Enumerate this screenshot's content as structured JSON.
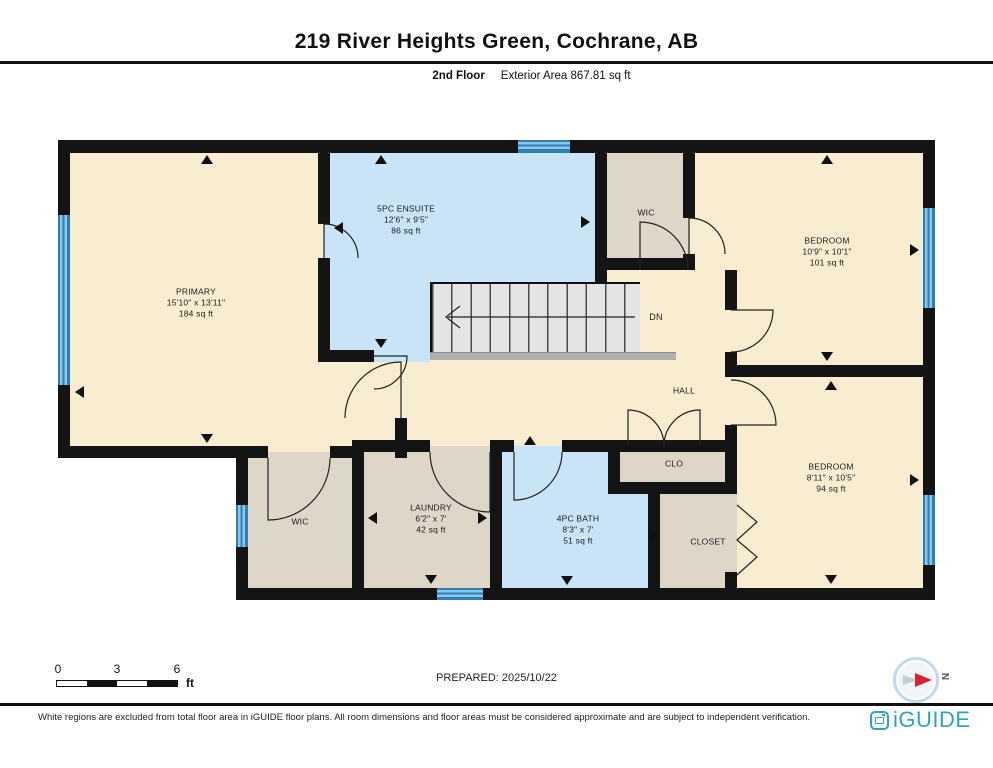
{
  "header": {
    "title": "219 River Heights Green, Cochrane, AB",
    "floor": "2nd Floor",
    "area": "Exterior Area 867.81 sq ft"
  },
  "rooms": {
    "primary": {
      "name": "PRIMARY",
      "dims": "15'10\" x 13'11\"",
      "area": "184 sq ft"
    },
    "ensuite": {
      "name": "5PC ENSUITE",
      "dims": "12'6\" x 9'5\"",
      "area": "86 sq ft"
    },
    "wic_top": {
      "name": "WIC"
    },
    "bedroom_ne": {
      "name": "BEDROOM",
      "dims": "10'9\" x 10'1\"",
      "area": "101 sq ft"
    },
    "bedroom_se": {
      "name": "BEDROOM",
      "dims": "8'11\" x 10'5\"",
      "area": "94 sq ft"
    },
    "hall": {
      "name": "HALL"
    },
    "stairs": {
      "label": "DN"
    },
    "clo": {
      "name": "CLO"
    },
    "closet": {
      "name": "CLOSET"
    },
    "wic_bottom": {
      "name": "WIC"
    },
    "laundry": {
      "name": "LAUNDRY",
      "dims": "6'2\" x 7'",
      "area": "42 sq ft"
    },
    "bath": {
      "name": "4PC BATH",
      "dims": "8'3\" x 7'",
      "area": "51 sq ft"
    }
  },
  "scale": {
    "start": "0",
    "mid": "3",
    "end": "6",
    "unit": "ft"
  },
  "prepared": "PREPARED: 2025/10/22",
  "compass": {
    "north": "N"
  },
  "footer": {
    "disclaimer": "White regions are excluded from total floor area in iGUIDE floor plans. All room dimensions and floor areas must be considered approximate and are subject to independent verification.",
    "brand": "iGUIDE"
  },
  "colors": {
    "wall": "#141414",
    "room_floor": "#f8edd1",
    "wet_room_floor": "#c9e4f6",
    "closet_floor": "#ded6c9",
    "window": "#4d9fd6",
    "brand": "#2ea3c4",
    "compass_needle": "#d8262c"
  }
}
